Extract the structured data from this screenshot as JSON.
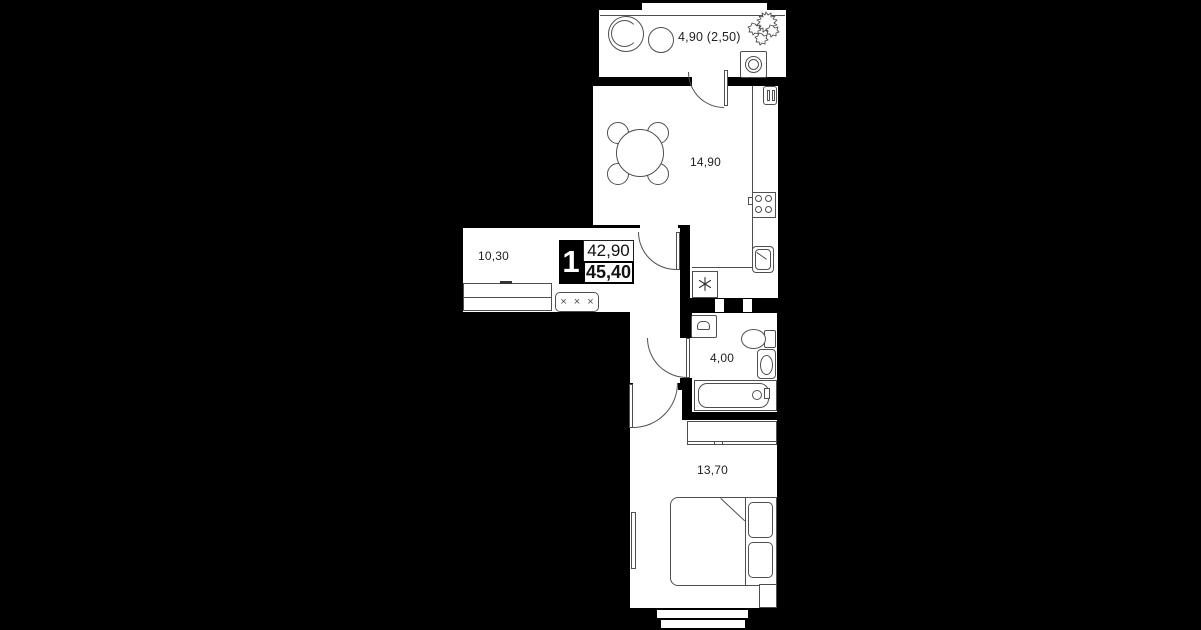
{
  "title": "Apartment floor plan",
  "badge": {
    "rooms_count": "1",
    "living_area": "42,90",
    "total_area": "45,40"
  },
  "rooms": {
    "balcony": {
      "area_label": "4,90 (2,50)"
    },
    "kitchen_living": {
      "area_label": "14,90"
    },
    "hallway": {
      "area_label": "10,30"
    },
    "bathroom": {
      "area_label": "4,00"
    },
    "bedroom": {
      "area_label": "13,70"
    }
  },
  "symbols": {
    "coat_hooks": "×××"
  },
  "colors": {
    "background": "#000000",
    "floor": "#ffffff",
    "wall_line": "#4f4f4f",
    "text": "#1f1f1f",
    "badge_bg": "#000000",
    "badge_text": "#ffffff"
  }
}
